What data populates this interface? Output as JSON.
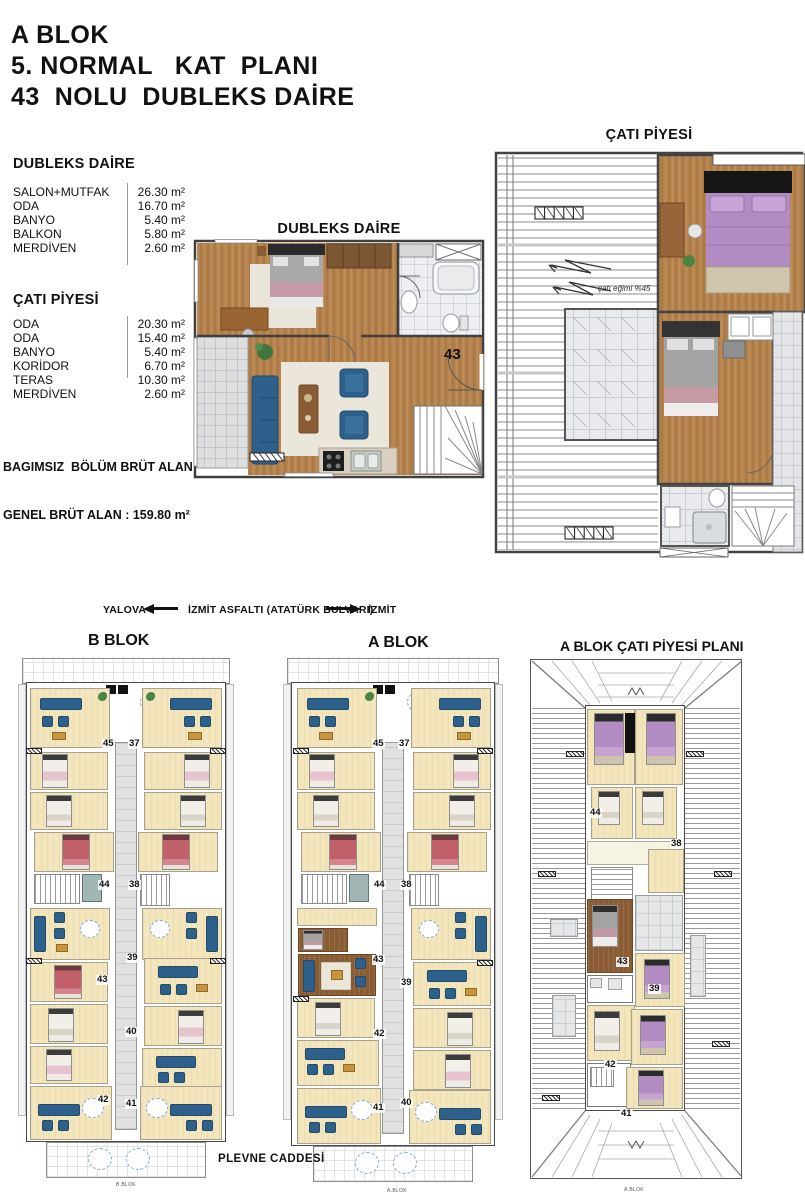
{
  "header": {
    "line1": "A BLOK",
    "line2": "5. NORMAL   KAT  PLANI",
    "line3": "43  NOLU  DUBLEKS DAİRE"
  },
  "area_tables": {
    "dubleks": {
      "title": "DUBLEKS DAİRE",
      "rows": [
        {
          "label": "SALON+MUTFAK",
          "value": "26.30 m²"
        },
        {
          "label": "ODA",
          "value": "16.70 m²"
        },
        {
          "label": "BANYO",
          "value": "5.40 m²"
        },
        {
          "label": "BALKON",
          "value": "5.80 m²"
        },
        {
          "label": "MERDİVEN",
          "value": "2.60 m²"
        }
      ]
    },
    "cati": {
      "title": "ÇATI PİYESİ",
      "rows": [
        {
          "label": "ODA",
          "value": "20.30 m²"
        },
        {
          "label": "ODA",
          "value": "15.40 m²"
        },
        {
          "label": "BANYO",
          "value": "5.40 m²"
        },
        {
          "label": "KORİDOR",
          "value": "6.70 m²"
        },
        {
          "label": "TERAS",
          "value": "10.30 m²"
        },
        {
          "label": "MERDİVEN",
          "value": "2.60 m²"
        }
      ]
    },
    "totals": {
      "line1": "BAGIMSIZ  BÖLÜM BRÜT ALAN :112.30m²",
      "line2": "GENEL BRÜT ALAN : 159.80 m²"
    }
  },
  "unit_plans": {
    "dubleks_title": "DUBLEKS DAİRE",
    "cati_title": "ÇATI PİYESİ",
    "unit_number": "43",
    "roof_slope_note": "çatı eğimi %45"
  },
  "road": {
    "left_city": "YALOVA",
    "name": "İZMİT ASFALTI  (ATATÜRK  BULVARI)",
    "right_city": "İZMİT",
    "bottom_street": "PLEVNE CADDESİ"
  },
  "site_plans": {
    "b_blok": {
      "title": "B BLOK",
      "caption": "B.BLOK",
      "units": {
        "n45": "45",
        "n37": "37",
        "n44": "44",
        "n38": "38",
        "n43": "43",
        "n39": "39",
        "n40": "40",
        "n42": "42",
        "n41": "41"
      }
    },
    "a_blok": {
      "title": "A BLOK",
      "caption": "A.BLOK",
      "units": {
        "n45": "45",
        "n37": "37",
        "n44": "44",
        "n38": "38",
        "n43": "43",
        "n39": "39",
        "n40": "40",
        "n42": "42",
        "n41": "41"
      }
    },
    "cati_plani": {
      "title": "A BLOK ÇATI  PİYESİ  PLANI",
      "caption": "A.BLOK",
      "units": {
        "n44": "44",
        "n38": "38",
        "n43": "43",
        "n39": "39",
        "n42": "42",
        "n41": "41"
      }
    }
  },
  "colors": {
    "wood_floor": "#b5834e",
    "dark_wood_floor": "#8a5c33",
    "cream_floor": "#f3e6bd",
    "sofa_blue": "#2d608a",
    "bed_pink": "#e6c3cf",
    "bed_red": "#c2606a",
    "bed_purple": "#b48cc4",
    "tile_gray": "#e6e7e9",
    "wall_dark": "#4a4a4a"
  }
}
